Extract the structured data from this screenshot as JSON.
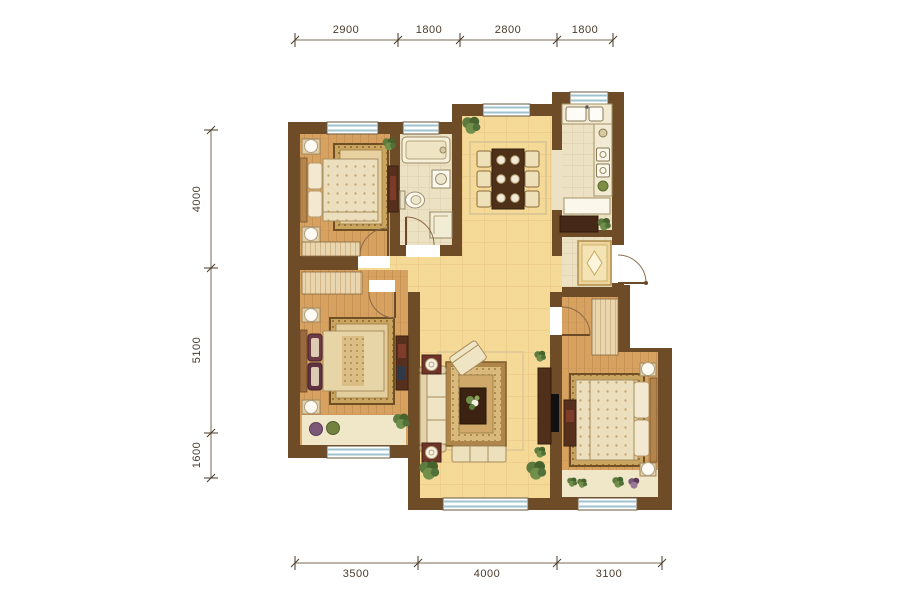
{
  "plan": {
    "type": "residential-floor-plan",
    "rooms": [
      "bedroom-top-left",
      "bathroom",
      "dining-area",
      "kitchen",
      "entry",
      "bedroom-left",
      "living-room",
      "bedroom-right"
    ]
  },
  "dimensions": {
    "top": [
      "2900",
      "1800",
      "2800",
      "1800"
    ],
    "left": [
      "4000",
      "5100",
      "1600"
    ],
    "bottom": [
      "3500",
      "4000",
      "3100"
    ]
  },
  "colors": {
    "wall": "#6f4c28",
    "tile_floor": "#f5d996",
    "bath_tile": "#ece1c2",
    "wood_floor": "#d7a160",
    "window_glass": "#9fc3cf",
    "rug": "#b08549",
    "plant": "#5d7b3e",
    "dim_text": "#4a3b2c"
  }
}
